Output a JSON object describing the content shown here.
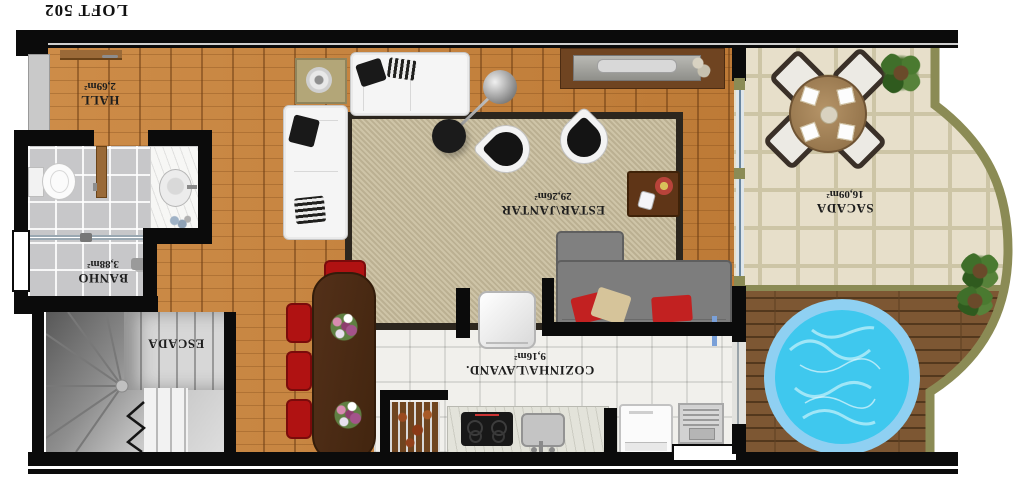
{
  "title": "LOFT 502",
  "rooms": {
    "hall": {
      "name": "HALL",
      "area": "2,69m²"
    },
    "banho": {
      "name": "BANHO",
      "area": "3,88m²"
    },
    "escada": {
      "name": "ESCADA",
      "area": ""
    },
    "estar": {
      "name": "ESTAR\\JANTAR",
      "area": "29,26m²"
    },
    "cozinha": {
      "name": "COZINHA\\LAVAND.",
      "area": "9,16m²"
    },
    "sacada": {
      "name": "SACADA",
      "area": "16,09m²"
    }
  },
  "colors": {
    "wall": "#0b0b0b",
    "wood_floor": "#c5823f",
    "kitchen_tile": "#f1f0ec",
    "bath_tile": "#c7c7c9",
    "sacada_tile": "#e7dfca",
    "deck_wood": "#7d5733",
    "pool_rim": "#8fd0f2",
    "pool_water": "#3fc8ee",
    "rug": "#cec4a7",
    "sofa_gray": "#7d7d7d",
    "chair_red": "#b01212",
    "table_wood": "#4a2c15",
    "trim_olive": "#8b8b55"
  }
}
